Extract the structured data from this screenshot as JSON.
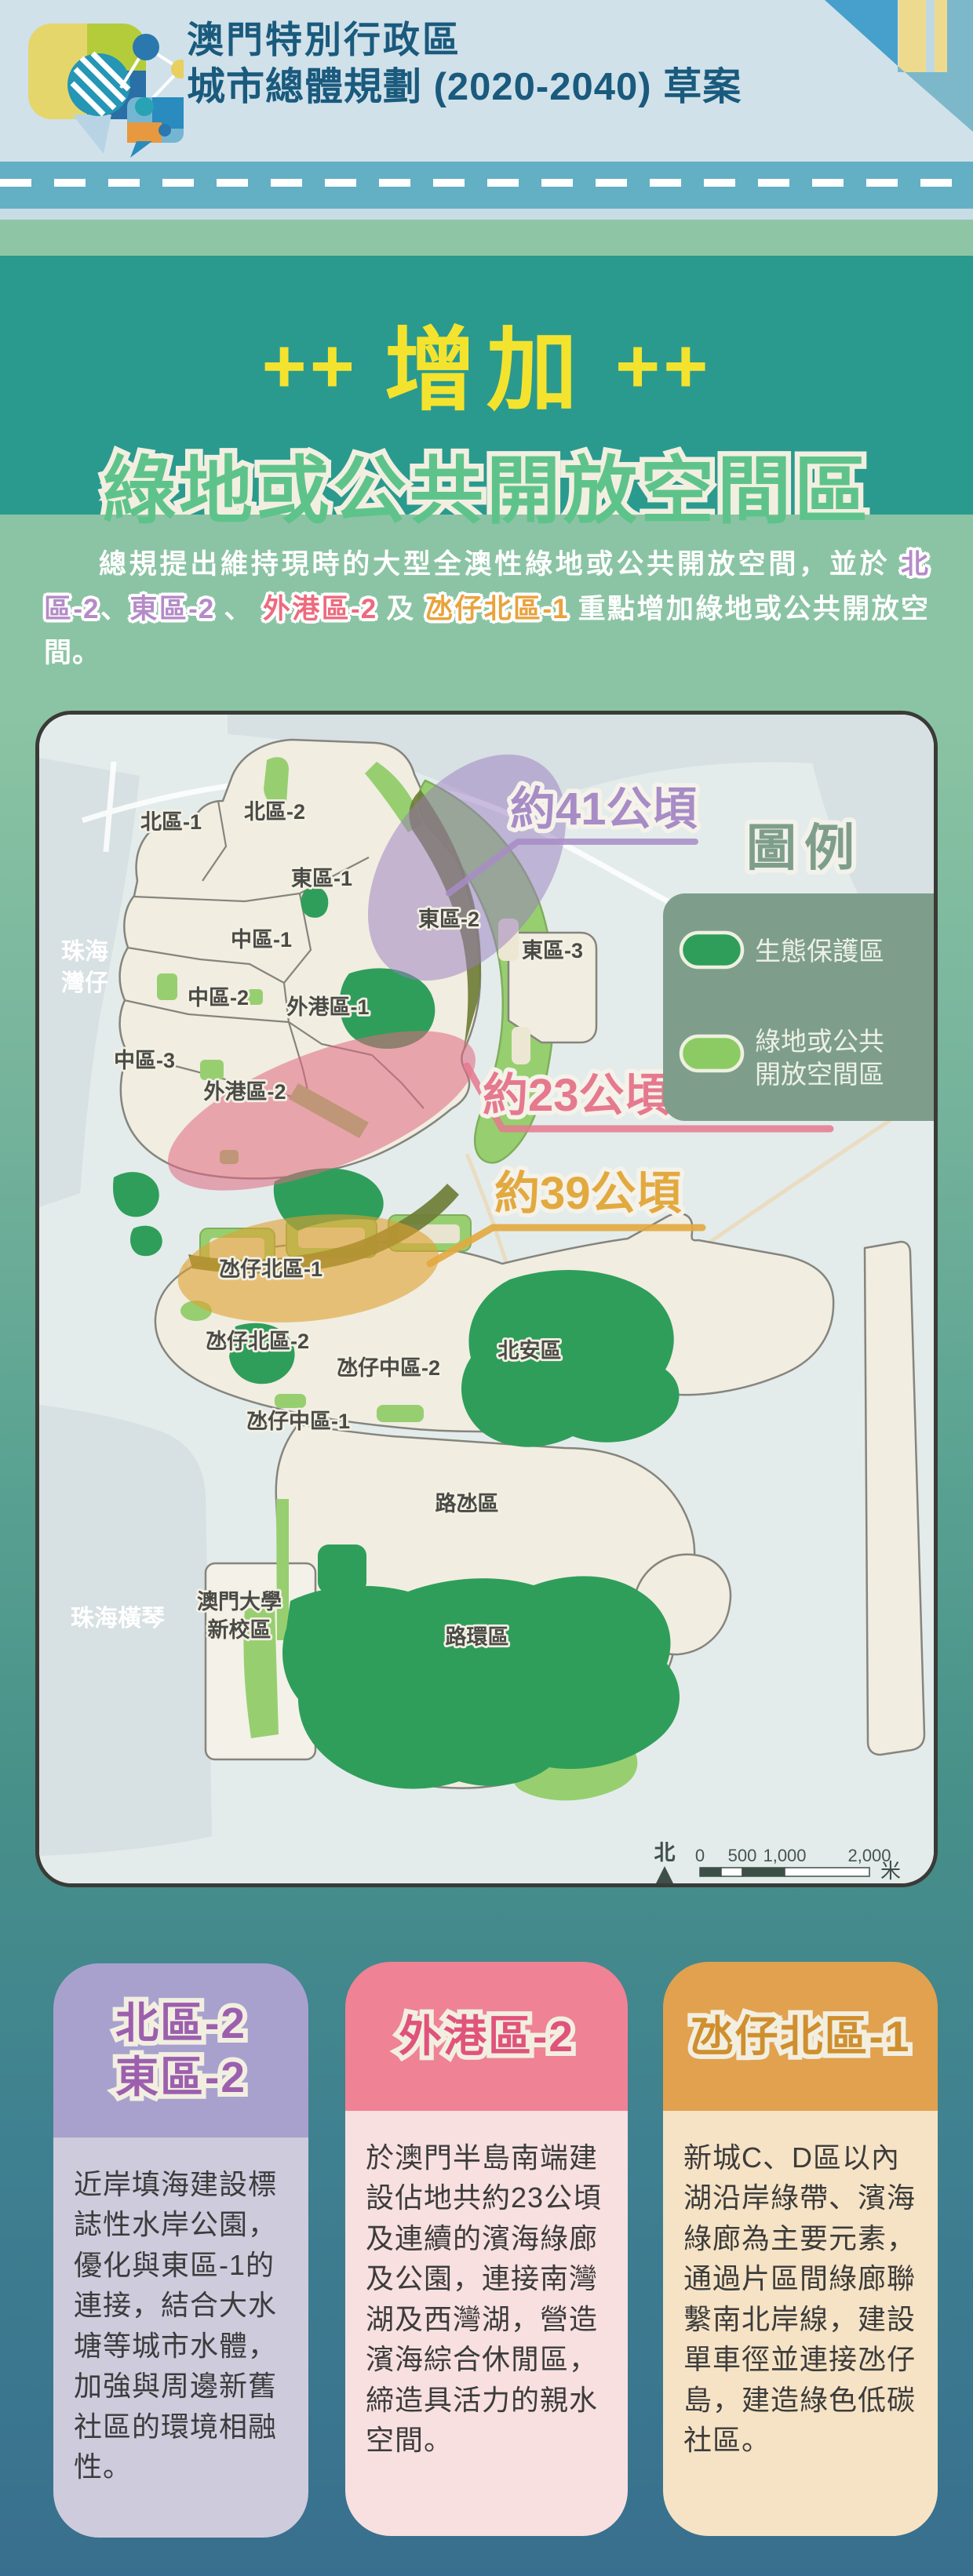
{
  "header": {
    "title_line1": "澳門特別行政區",
    "title_line2": "城市總體規劃 (2020-2040) 草案"
  },
  "hero": {
    "plus_left": "++",
    "plus_right": "++",
    "title": "增加",
    "subtitle": "綠地或公共開放空間區"
  },
  "intro": {
    "lead": "總規提出維持現時的大型全澳性綠地或公共開放空間，並於 ",
    "h1": "北區-2",
    "s1": "、",
    "h2": "東區-2",
    "s2": " 、 ",
    "h3": "外港區-2",
    "s3": " 及 ",
    "h4": "氹仔北區-1",
    "tail": " 重點增加綠地或公共開放空間。"
  },
  "map": {
    "callout_41": "約41公頃",
    "callout_23": "約23公頃",
    "callout_39": "約39公頃",
    "regions": [
      "北區-1",
      "北區-2",
      "東區-1",
      "東區-2",
      "東區-3",
      "中區-1",
      "中區-2",
      "外港區-1",
      "中區-3",
      "外港區-2",
      "氹仔北區-1",
      "氹仔北區-2",
      "氹仔中區-2",
      "北安區",
      "氹仔中區-1",
      "路氹區",
      "路環區"
    ],
    "place_zhuhai_1": "珠海",
    "place_zhuhai_2": "灣仔",
    "place_hengqin": "珠海橫琴",
    "place_um_1": "澳門大學",
    "place_um_2": "新校區",
    "legend": {
      "title": "圖例",
      "item1": "生態保護區",
      "item2_line1": "綠地或公共",
      "item2_line2": "開放空間區"
    },
    "scalebar": {
      "north": "北",
      "t0": "0",
      "t500": "500",
      "t1000": "1,000",
      "t2000": "2,000",
      "unit": "米"
    }
  },
  "cards": [
    {
      "title1": "北區-2",
      "title2": "東區-2",
      "body": "近岸填海建設標誌性水岸公園，優化與東區-1的連接，結合大水塘等城市水體，加強與周邊新舊社區的環境相融性。"
    },
    {
      "title1": "外港區-2",
      "body": "於澳門半島南端建設佔地共約23公頃及連續的濱海綠廊及公園，連接南灣湖及西灣湖，營造濱海綜合休閒區，締造具活力的親水空間。"
    },
    {
      "title1": "氹仔北區-1",
      "body": "新城C、D區以內湖沿岸綠帶、濱海綠廊為主要元素，通過片區間綠廊聯繫南北岸線，建設單車徑並連接氹仔島，建造綠色低碳社區。"
    }
  ],
  "colors": {
    "header_text": "#1a5a7d",
    "hero_yellow": "#f4e32e",
    "hero_green": "#5ec38b",
    "eco_green": "#2f9e5a",
    "open_green": "#8ccb63",
    "callout_purple": "#a78cc6",
    "callout_pink": "#e5798e",
    "callout_orange": "#e2a93f",
    "card1_accent": "#9c5fae",
    "card2_accent": "#e0537a",
    "card3_accent": "#d08f2e"
  }
}
